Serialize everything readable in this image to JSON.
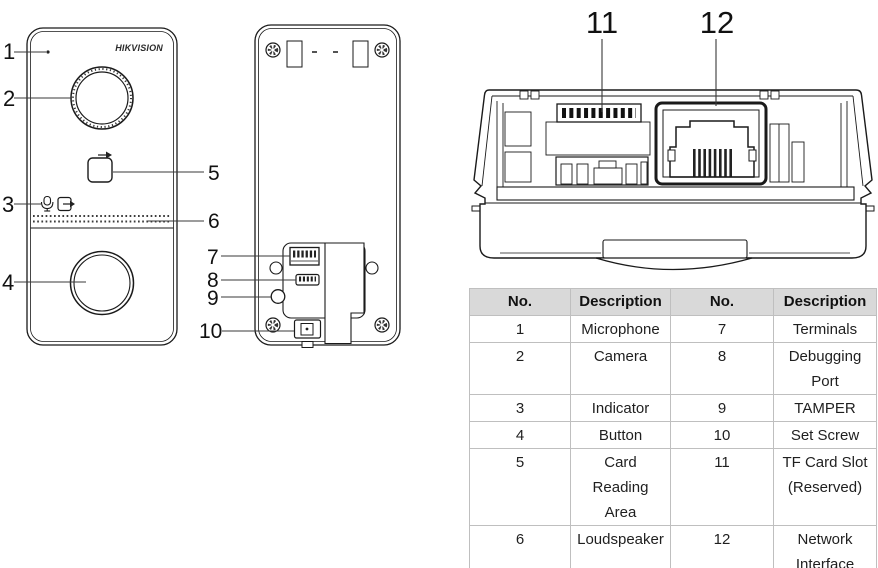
{
  "brand": {
    "logo_text": "HIKVISION"
  },
  "callouts": {
    "c1": "1",
    "c2": "2",
    "c3": "3",
    "c4": "4",
    "c5": "5",
    "c6": "6",
    "c7": "7",
    "c8": "8",
    "c9": "9",
    "c10": "10",
    "c11": "11",
    "c12": "12"
  },
  "table": {
    "headers": [
      "No.",
      "Description",
      "No.",
      "Description"
    ],
    "rows": [
      [
        "1",
        "Microphone",
        "7",
        "Terminals"
      ],
      [
        "2",
        "Camera",
        "8",
        "Debugging Port"
      ],
      [
        "3",
        "Indicator",
        "9",
        "TAMPER"
      ],
      [
        "4",
        "Button",
        "10",
        "Set Screw"
      ],
      [
        "5",
        "Card Reading Area",
        "11",
        "TF Card Slot (Reserved)"
      ],
      [
        "6",
        "Loudspeaker",
        "12",
        "Network Interface"
      ]
    ]
  },
  "colors": {
    "table_header_bg": "#d9d9d9",
    "table_border": "#bfbfbf",
    "line_art": "#1a1a1a"
  }
}
